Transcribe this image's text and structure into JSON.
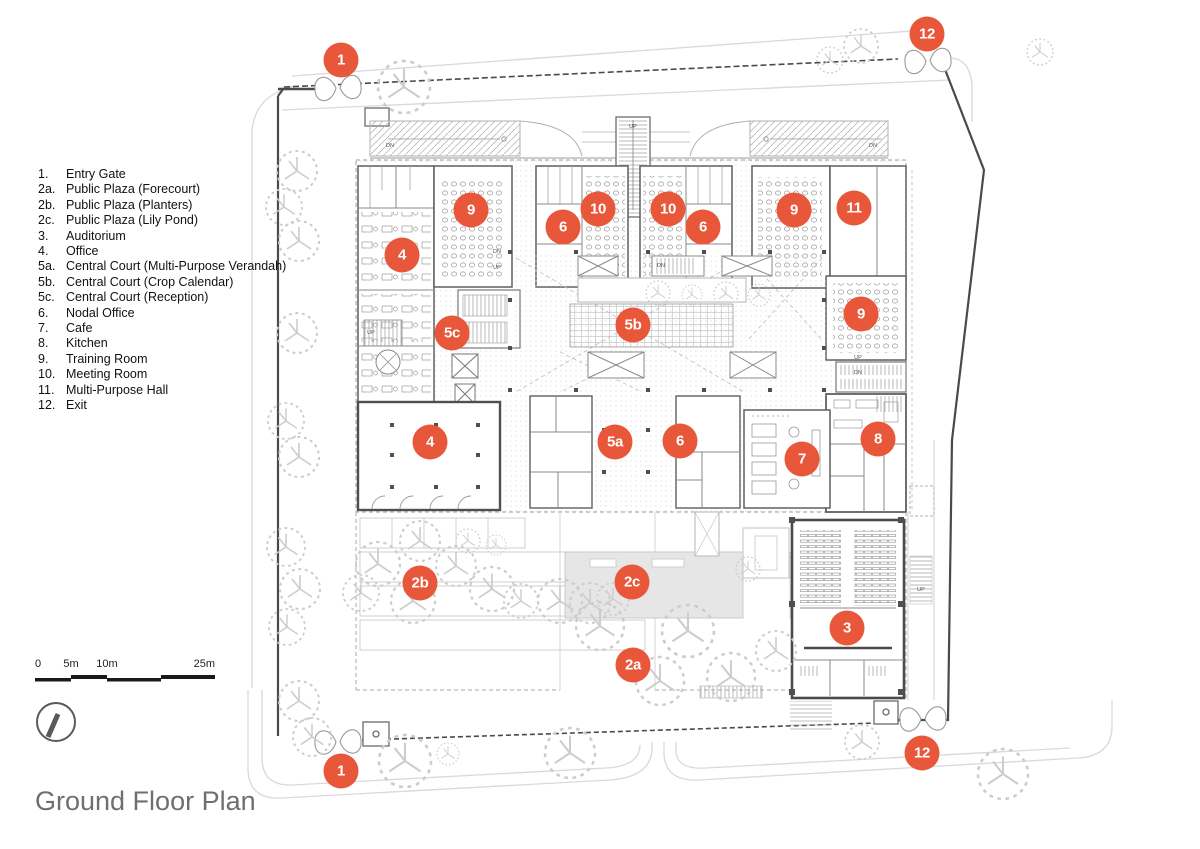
{
  "title": "Ground Floor Plan",
  "legend": {
    "items": [
      {
        "num": "1.",
        "label": "Entry Gate"
      },
      {
        "num": "2a.",
        "label": "Public Plaza (Forecourt)"
      },
      {
        "num": "2b.",
        "label": "Public Plaza (Planters)"
      },
      {
        "num": "2c.",
        "label": "Public Plaza (Lily Pond)"
      },
      {
        "num": "3.",
        "label": "Auditorium"
      },
      {
        "num": "4.",
        "label": "Office"
      },
      {
        "num": "5a.",
        "label": "Central Court (Multi-Purpose Verandah)"
      },
      {
        "num": "5b.",
        "label": "Central Court (Crop Calendar)"
      },
      {
        "num": "5c.",
        "label": "Central Court (Reception)"
      },
      {
        "num": "6.",
        "label": "Nodal Office"
      },
      {
        "num": "7.",
        "label": "Cafe"
      },
      {
        "num": "8.",
        "label": "Kitchen"
      },
      {
        "num": "9.",
        "label": "Training Room"
      },
      {
        "num": "10.",
        "label": "Meeting Room"
      },
      {
        "num": "11.",
        "label": "Multi-Purpose Hall"
      },
      {
        "num": "12.",
        "label": "Exit"
      }
    ]
  },
  "markers": [
    {
      "label": "1",
      "x": 341,
      "y": 60
    },
    {
      "label": "12",
      "x": 927,
      "y": 34
    },
    {
      "label": "9",
      "x": 471,
      "y": 210
    },
    {
      "label": "6",
      "x": 563,
      "y": 227
    },
    {
      "label": "10",
      "x": 598,
      "y": 209
    },
    {
      "label": "10",
      "x": 668,
      "y": 209
    },
    {
      "label": "6",
      "x": 703,
      "y": 227
    },
    {
      "label": "9",
      "x": 794,
      "y": 210
    },
    {
      "label": "11",
      "x": 854,
      "y": 208
    },
    {
      "label": "4",
      "x": 402,
      "y": 255
    },
    {
      "label": "5c",
      "x": 452,
      "y": 333
    },
    {
      "label": "5b",
      "x": 633,
      "y": 325
    },
    {
      "label": "9",
      "x": 861,
      "y": 314
    },
    {
      "label": "4",
      "x": 430,
      "y": 442
    },
    {
      "label": "5a",
      "x": 615,
      "y": 442
    },
    {
      "label": "6",
      "x": 680,
      "y": 441
    },
    {
      "label": "7",
      "x": 802,
      "y": 459
    },
    {
      "label": "8",
      "x": 878,
      "y": 439
    },
    {
      "label": "2b",
      "x": 420,
      "y": 583
    },
    {
      "label": "2c",
      "x": 632,
      "y": 582
    },
    {
      "label": "3",
      "x": 847,
      "y": 628
    },
    {
      "label": "2a",
      "x": 633,
      "y": 665
    },
    {
      "label": "1",
      "x": 341,
      "y": 771
    },
    {
      "label": "12",
      "x": 922,
      "y": 753
    }
  ],
  "plan_labels": [
    {
      "text": "UP",
      "x": 633,
      "y": 127
    },
    {
      "text": "DN",
      "x": 390,
      "y": 146
    },
    {
      "text": "DN",
      "x": 873,
      "y": 146
    },
    {
      "text": "DN",
      "x": 497,
      "y": 252
    },
    {
      "text": "UP",
      "x": 497,
      "y": 268
    },
    {
      "text": "DN",
      "x": 661,
      "y": 266
    },
    {
      "text": "UP",
      "x": 371,
      "y": 333
    },
    {
      "text": "UP",
      "x": 858,
      "y": 358
    },
    {
      "text": "DN",
      "x": 858,
      "y": 373
    },
    {
      "text": "UP",
      "x": 921,
      "y": 590
    }
  ],
  "scalebar": {
    "labels": [
      {
        "text": "0",
        "x": 0,
        "align": "left"
      },
      {
        "text": "5m",
        "x": 36,
        "align": "center"
      },
      {
        "text": "10m",
        "x": 72,
        "align": "center"
      },
      {
        "text": "25m",
        "x": 180,
        "align": "right"
      }
    ]
  },
  "colors": {
    "marker_fill": "#e8573a",
    "marker_text": "#ffffff",
    "title_text": "#6e6f71",
    "legend_text": "#111111",
    "boundary_line": "#4a4a4a",
    "plan_line": "#8a8a8a",
    "pond_fill": "#e6e6e6"
  }
}
